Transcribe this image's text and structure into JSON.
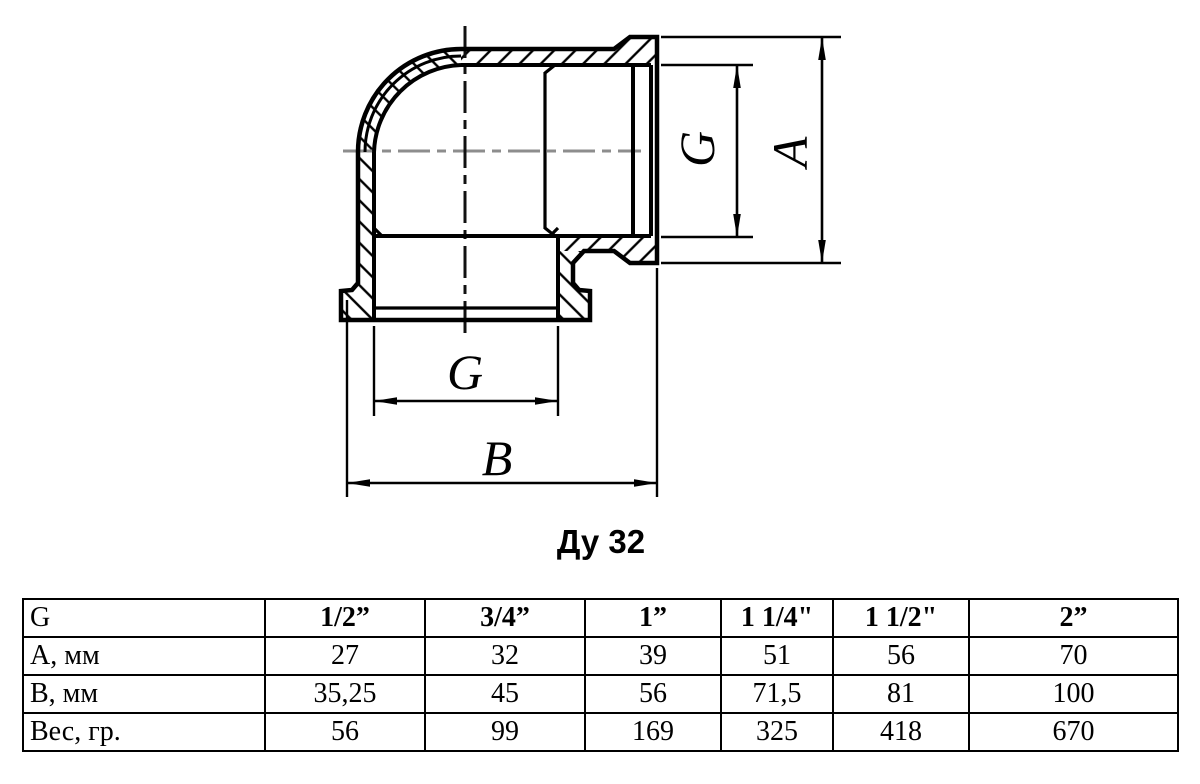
{
  "drawing": {
    "caption": "Ду 32",
    "dims": {
      "g_right": "G",
      "a_overall": "A",
      "g_bottom": "G",
      "b_overall": "B"
    }
  },
  "table": {
    "header": {
      "col0": "G",
      "sizes": [
        "1/2”",
        "3/4”",
        "1”",
        "1 1/4\"",
        "1 1/2\"",
        "2”"
      ]
    },
    "rows": [
      {
        "label": "A, мм",
        "values": [
          "27",
          "32",
          "39",
          "51",
          "56",
          "70"
        ]
      },
      {
        "label": "B, мм",
        "values": [
          "35,25",
          "45",
          "56",
          "71,5",
          "81",
          "100"
        ]
      },
      {
        "label": "Вес, гр.",
        "values": [
          "56",
          "99",
          "169",
          "325",
          "418",
          "670"
        ]
      }
    ]
  }
}
